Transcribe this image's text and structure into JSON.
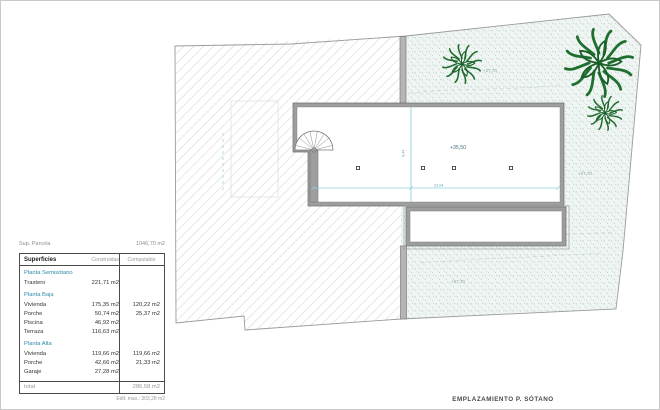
{
  "sheet": {
    "caption": "EMPLAZAMIENTO P. SÓTANO"
  },
  "parcel": {
    "label": "Sup. Parcela",
    "area": "1046,70 m2",
    "max_edificability": "Edif. max.: 303,28 m2"
  },
  "areas_table": {
    "headers": {
      "col1": "Superficies",
      "col2": "Construidas",
      "col3": "Computable"
    },
    "sections": [
      {
        "name": "Planta Semisótano",
        "rows": [
          {
            "label": "Trastero",
            "construida": "221,71 m2",
            "computable": ""
          }
        ]
      },
      {
        "name": "Planta Baja",
        "rows": [
          {
            "label": "Vivienda",
            "construida": "175,35 m2",
            "computable": "120,22 m2"
          },
          {
            "label": "Porche",
            "construida": "50,74 m2",
            "computable": "25,37 m2"
          },
          {
            "label": "Piscina",
            "construida": "46,92 m2",
            "computable": ""
          },
          {
            "label": "Terraza",
            "construida": "116,63 m2",
            "computable": ""
          }
        ]
      },
      {
        "name": "Planta Alta",
        "rows": [
          {
            "label": "Vivienda",
            "construida": "119,66 m2",
            "computable": "119,66 m2"
          },
          {
            "label": "Porche",
            "construida": "42,66 m2",
            "computable": "21,33 m2"
          },
          {
            "label": "Garaje",
            "construida": "27,28 m2",
            "computable": ""
          }
        ]
      }
    ],
    "total": {
      "label": "total",
      "value": "286,58 m2"
    }
  },
  "plan": {
    "basement_level": "+35,50",
    "garden_level": "+27,70",
    "dim_width": "23,04",
    "dim_height": "9,44",
    "colors": {
      "dimension_cyan": "#8fd2de",
      "level_text_teal": "#44707c",
      "table_section_teal": "#2d8bab",
      "plant_green": "#1f7030",
      "wall_gray": "#9e9e9e",
      "hatch_gray": "#cbcbcb",
      "stipple_green": "#a3b8ae"
    }
  }
}
